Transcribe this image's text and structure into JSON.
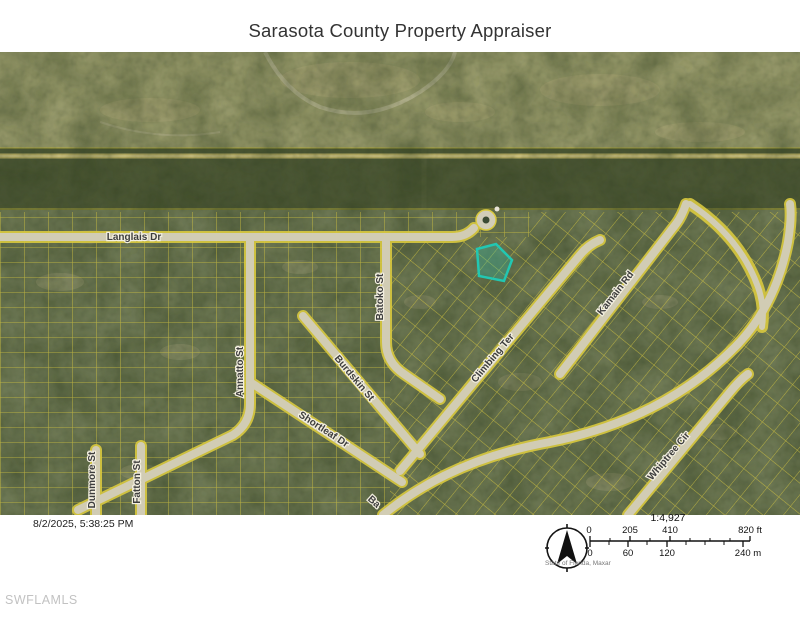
{
  "header": {
    "title": "Sarasota County Property Appraiser"
  },
  "map": {
    "street_labels": [
      {
        "text": "Langlais Dr"
      },
      {
        "text": "Batoko St"
      },
      {
        "text": "Annatto St"
      },
      {
        "text": "Burdskin St"
      },
      {
        "text": "Shortleaf Dr"
      },
      {
        "text": "Climbing Ter"
      },
      {
        "text": "Kamain Rd"
      },
      {
        "text": "Whiptree Cir"
      },
      {
        "text": "Dunmore St"
      },
      {
        "text": "Fatton St"
      },
      {
        "text": "Ba"
      }
    ],
    "colors": {
      "parcel_lines": "#d9c93f",
      "highlighted_parcel": "#22c7b2",
      "streets": "#d2cdb8",
      "vegetation_dark": "#46522f",
      "open_land": "#a2a372"
    }
  },
  "scale": {
    "ratio": "1:4,927",
    "feet_labels": [
      "0",
      "205",
      "410",
      "820 ft"
    ],
    "meter_labels": [
      "0",
      "60",
      "120",
      "240 m"
    ],
    "attribution": "State of Florida, Maxar",
    "north_arrow_icon": "▲"
  },
  "footer": {
    "timestamp": "8/2/2025, 5:38:25 PM",
    "watermark": "SWFLAMLS"
  }
}
